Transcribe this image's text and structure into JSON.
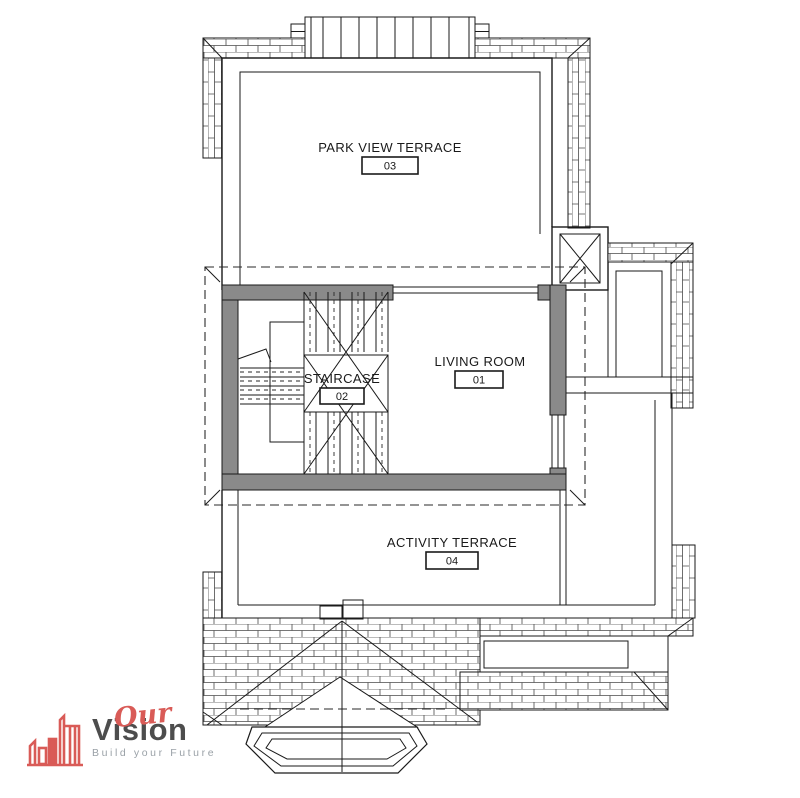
{
  "floor_plan": {
    "rooms": [
      {
        "name": "PARK VIEW TERRACE",
        "number": "03"
      },
      {
        "name": "LIVING ROOM",
        "number": "01"
      },
      {
        "name": "STAIRCASE",
        "number": "02"
      },
      {
        "name": "ACTIVITY TERRACE",
        "number": "04"
      }
    ],
    "colors": {
      "wall_fill": "#8a8a8a",
      "line": "#1a1a1a",
      "hatch_line": "#4a4a4a"
    }
  },
  "logo": {
    "name_line1": "Our",
    "name_line2": "Vision",
    "tagline": "Build your Future",
    "colors": {
      "accent": "#d95b57",
      "dark": "#4d4d4d",
      "tagline_gray": "#9aa1a7"
    }
  }
}
